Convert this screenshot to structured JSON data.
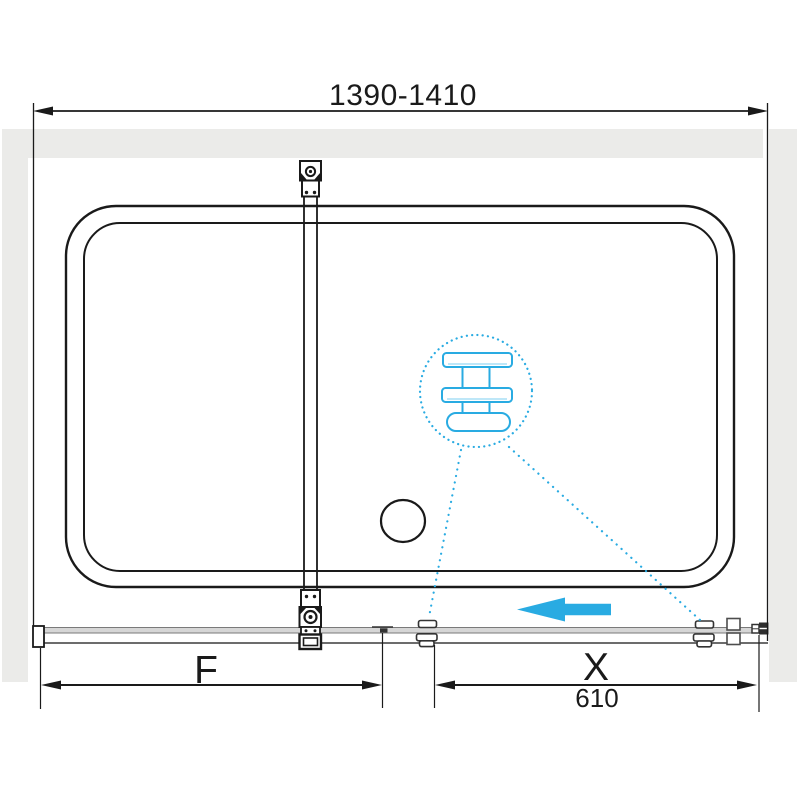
{
  "drawing": {
    "type": "shower-enclosure-dimension-diagram",
    "labels": {
      "overall_width": "1390-1410",
      "fixed_panel": "F",
      "sliding_door": "X",
      "sliding_door_width": "610"
    },
    "colors": {
      "accent_blue": "#29ABE2",
      "wall_gray": "#EBEBE9",
      "rail_gray": "#D6D6D6",
      "line_dark": "#1A1A1A"
    },
    "icons": {
      "detail_bubble": "towel-bar-zoom-detail-icon",
      "direction_arrow": "slide-left-arrow-icon",
      "drain": "drain-circle-icon"
    }
  }
}
